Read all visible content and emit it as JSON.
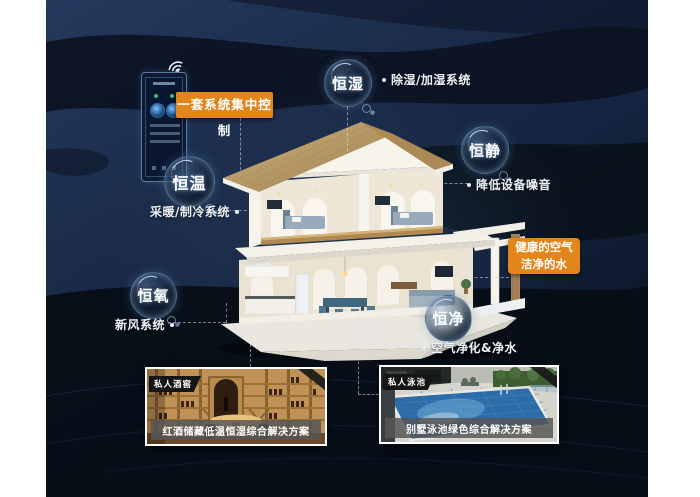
{
  "colors": {
    "accent_orange": "#e2861c",
    "background_navy": "#16263e",
    "margin_white": "#ffffff",
    "bubble_text": "#ffffff"
  },
  "icons": {
    "phone_wifi": "wifi-icon",
    "connector_dot": "dot"
  },
  "control_label": "一套系统集中控制",
  "features": [
    {
      "bubble": "恒湿",
      "label": "除湿/加湿系统"
    },
    {
      "bubble": "恒静",
      "label": "降低设备噪音"
    },
    {
      "bubble": "恒温",
      "label": "采暖/制冷系统"
    },
    {
      "bubble": "恒氧",
      "label": "新风系统"
    },
    {
      "bubble": "恒净",
      "label": "空气净化&净水"
    }
  ],
  "highlight_box": {
    "line1": "健康的空气",
    "line2": "洁净的水"
  },
  "cards": [
    {
      "badge": "私人酒窖",
      "caption": "红酒储藏低温恒湿综合解决方案"
    },
    {
      "badge": "私人泳池",
      "caption": "别墅泳池绿色综合解决方案"
    }
  ]
}
